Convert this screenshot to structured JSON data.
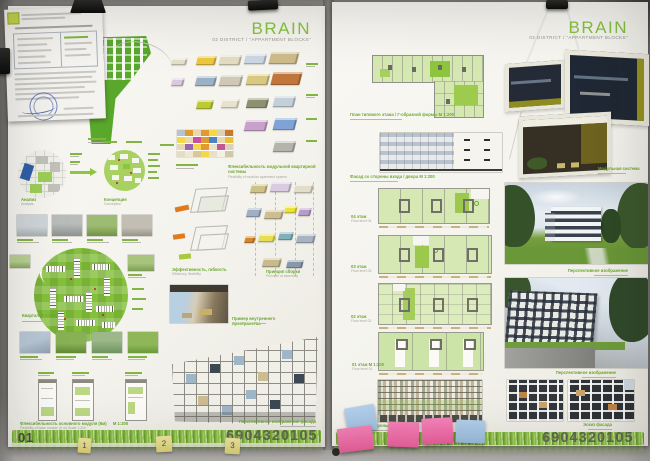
{
  "scene": {
    "tabs": [
      "1",
      "2",
      "3"
    ],
    "colors": {
      "accent_green": "#8dc63f",
      "label_green": "#6ca833",
      "grass_green": "#8ec34a",
      "sticky_pink": "#f06fae",
      "sticky_blue": "#a9c8e8",
      "sticky_yellow": "#e9df86",
      "stamp_blue": "#4a6ab0",
      "code_gray": "#5a5953"
    }
  },
  "board_left": {
    "number": "01",
    "code": "6904320105",
    "title": "BRAIN",
    "subtitle": "02 DISTRICT / \"APPARTMENT BLOCKS\"",
    "labels": {
      "analysis": "Анализ",
      "analysis_sub": "Analysis",
      "concept": "Концепция",
      "concept_sub": "Conception",
      "district_plan": "Квартал  М 1:1000",
      "module_flexibility": "Флексибельность основного модуля (6м)",
      "module_flexibility_scale": "М 1:200",
      "module_flexibility_sub": "Flexibility of base module (6 m)   Scale 1:200",
      "apartment_system": "Флексибельность модульной квартирной системы",
      "apartment_system_sub": "Flexibility of modular apartment system",
      "efficiency": "Эффективность, гибкость",
      "efficiency_sub": "Efficiency, flexibility",
      "assembly": "Принцип сборки",
      "assembly_sub": "Principle of assembly",
      "interior_example": "Пример внутреннего пространства",
      "facade_perspective": "Перспективное изображение фасада"
    }
  },
  "board_right": {
    "number": "02",
    "code": "6904320105",
    "title": "BRAIN",
    "subtitle": "02 DISTRICT / \"APPARTMENT BLOCKS\"",
    "labels": {
      "typical_plan": "План типового этажа / Г-образной формы  М 1:200",
      "entrance_facade": "Фасад со стороны входа / двора  М 1:200",
      "module_system": "Модульная система",
      "floor_04": "04 этаж",
      "floor_04_sub": "Floor level 04",
      "floor_03": "03 этаж",
      "floor_03_sub": "Floor level 03",
      "floor_02": "02 этаж",
      "floor_02_sub": "Floor level 02",
      "floor_01": "01 этаж  М 1:200",
      "floor_01_sub": "Floor level 01",
      "yard_facade": "Фасад со стороны двора  М 1:200",
      "perspective_1": "Перспективное изображение",
      "perspective_2": "Перспективное изображение",
      "facade_sketch": "Эскиз фасада"
    }
  }
}
